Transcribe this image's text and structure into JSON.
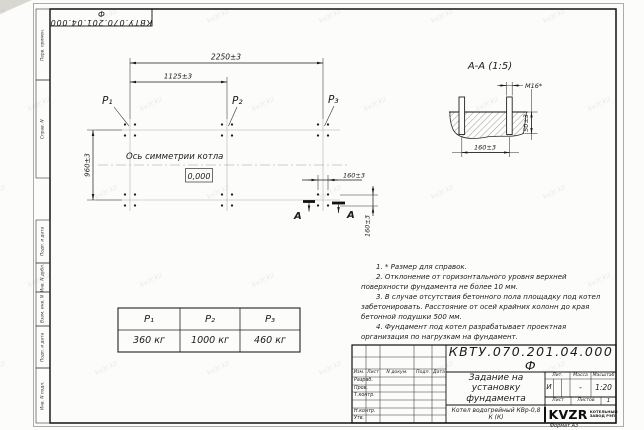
{
  "watermark": {
    "text": "kvzr.kz"
  },
  "frame": {
    "top_stamp": "КВТУ.070.201.04.000 Ф",
    "format_note": "Формат А3",
    "margin_labels": [
      "Перв. примен.",
      "Справ. N",
      "Подп. и дата",
      "Инв. N дубл.",
      "Взам. инв. N",
      "Подп. и дата",
      "Инв. N подл."
    ]
  },
  "plan": {
    "dim_total_width": "2250±3",
    "dim_half_width": "1125±3",
    "dim_depth": "960±3",
    "dim_bolt_spacing_x": "160±3",
    "dim_bolt_spacing_y": "160±3",
    "axis_label": "Ось симметрии котла",
    "elevation_mark": "0,000",
    "point_labels": [
      "P₁",
      "P₂",
      "P₃"
    ],
    "section_cut_label": "А"
  },
  "section_view": {
    "title": "А-А (1:5)",
    "thread_label": "M16*",
    "dim_protrusion": "50±3",
    "dim_bolt_spacing": "160±3"
  },
  "load_table": {
    "headers": [
      "P₁",
      "P₂",
      "P₃"
    ],
    "values": [
      "360 кг",
      "1000 кг",
      "460 кг"
    ]
  },
  "notes": [
    "1. * Размер для справок.",
    "2. Отклонение от горизонтального уровня верхней поверхности фундамента не более 10 мм.",
    "3. В случае отсутствия бетонного пола площадку под котел забетонировать. Расстояние от осей крайних колонн до края бетонной подушки 500 мм.",
    "4. Фундамент под котел разрабатывает проектная организация по нагрузкам на фундамент."
  ],
  "title_block": {
    "doc_number": "КВТУ.070.201.04.000 Ф",
    "doc_title": "Задание на установку фундамента",
    "product_name": "Котел водогрейный КВр-0,8 К (К)",
    "col_headers": [
      "Изм.",
      "Лист",
      "N докум.",
      "Подп.",
      "Дата"
    ],
    "row_labels": [
      "Разраб.",
      "Пров.",
      "Т.контр.",
      "Н.контр.",
      "Утв."
    ],
    "lit_label": "Лит.",
    "mass_label": "Масса",
    "scale_label": "Масштаб",
    "lit_value": "И",
    "mass_value": "-",
    "scale_value": "1:20",
    "sheet_label": "Лист",
    "sheets_label": "Листов",
    "sheets_value": "1",
    "logo_text": "KVZR",
    "logo_caption": [
      "КОТЕЛЬНЫЙ",
      "ЗАВОД РЭП"
    ]
  }
}
